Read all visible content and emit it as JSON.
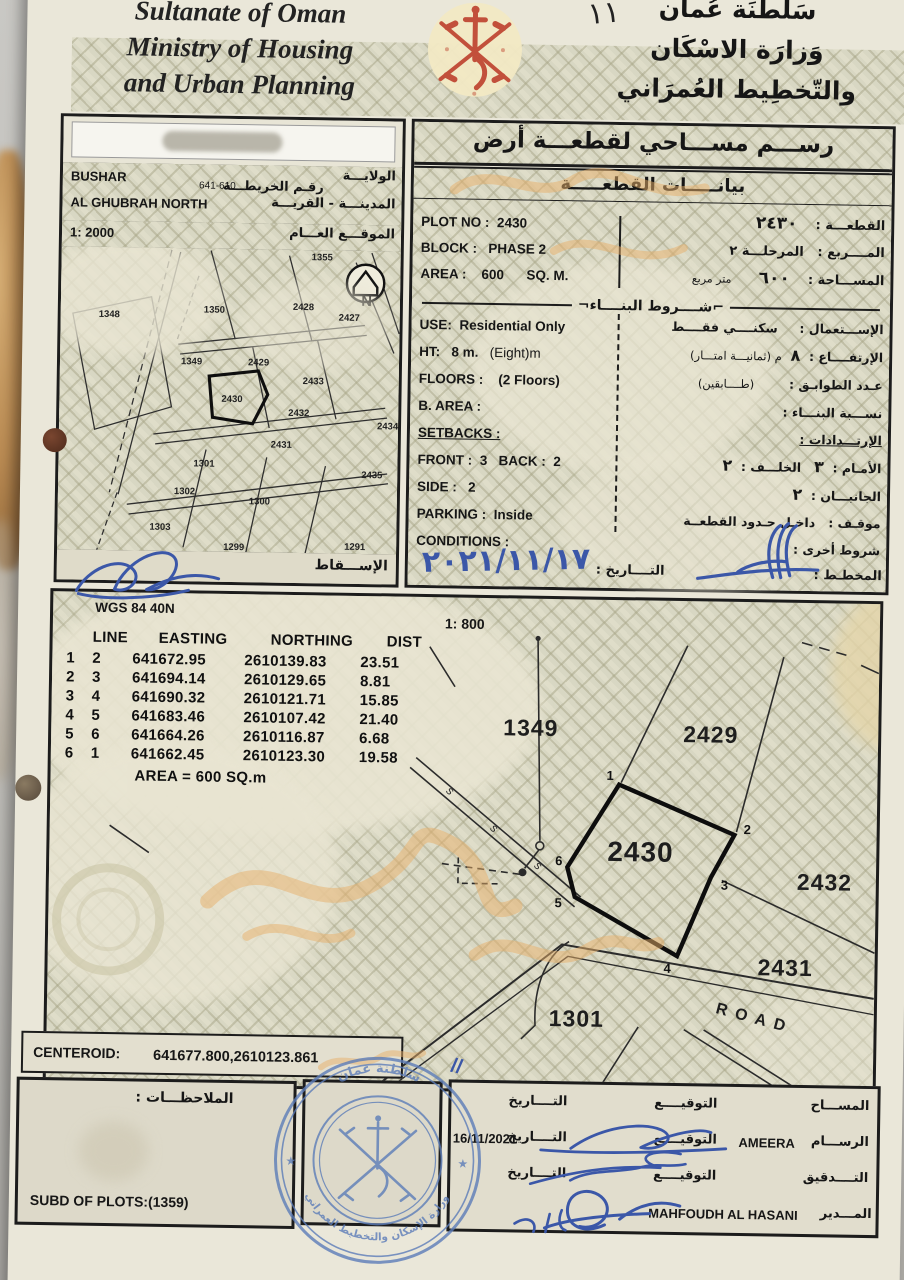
{
  "header": {
    "en_line1": "Sultanate of Oman",
    "en_line2": "Ministry of Housing",
    "en_line3": "and Urban Planning",
    "ar_line1": "سَلْطنَة عُمان",
    "ar_line2": "وَزارَة الاسْكَان",
    "ar_line3": "والتّخطِيط العُمرَاني",
    "page_mark": "١١"
  },
  "location": {
    "wilayat_label_ar": "الولايـــة",
    "wilayat_value": "BUSHAR",
    "map_no_label_ar": "رقـم الخريطـــة",
    "map_no": "641-610",
    "town_label_ar": "المدينـــة - القريـــة",
    "town_value": "AL GHUBRAH NORTH",
    "scale_label": "1: 2000",
    "site_label_ar": "الموقـــع العـــام",
    "projection_label_ar": "الإســـقاط"
  },
  "map_labels": [
    "1348",
    "1350",
    "1355",
    "2428",
    "2427",
    "1349",
    "2429",
    "2433",
    "2430",
    "2432",
    "2434",
    "2431",
    "1301",
    "1302",
    "1300",
    "2435",
    "1303",
    "1299",
    "1291"
  ],
  "title": {
    "main_ar": "رســـم مســـاحي لقطعـــة أرض",
    "sub_ar": "بيانـــــات القطعـــــة"
  },
  "plot": {
    "no_label": "PLOT NO :",
    "no": "2430",
    "block_label": "BLOCK :",
    "block": "PHASE 2",
    "area_label": "AREA :",
    "area": "600",
    "area_unit": "SQ. M.",
    "no_ar_label": "القطعـــة :",
    "no_ar_value": "٢٤٣٠",
    "block_ar_label": "المــــربع :",
    "block_ar_value": "المرحلـــة ٢",
    "area_ar_label": "المســـاحة :",
    "area_ar_value": "٦٠٠",
    "area_ar_unit": "متر مربع"
  },
  "building": {
    "header_ar": "شــــروط البنــــاء",
    "use_label": "USE:",
    "use_value": "Residential Only",
    "use_ar_label": "الإســـتعمال :",
    "use_ar_value": "سكنــــي فقــــط",
    "ht_label": "HT:",
    "ht_value": "8 m.",
    "ht_note": "(Eight)m",
    "ht_ar_label": "الإرتفــــاع :",
    "ht_ar_value": "٨",
    "ht_ar_note": "م  (ثمانيـــة امتـــار)",
    "floors_label": "FLOORS :",
    "floors_value": "(2 Floors)",
    "floors_ar_label": "عـدد الطوابـق :",
    "floors_ar_value": "(طــــابقين)",
    "barea_label": "B. AREA :",
    "barea_ar_label": "نســـبة البنـــاء :",
    "setbacks_label": "SETBACKS :",
    "setbacks_ar_label": "الإرتـــدادات :",
    "front_label": "FRONT :",
    "front_value": "3",
    "back_label": "BACK :",
    "back_value": "2",
    "front_ar_label": "الأمـام :",
    "front_ar_value": "٣",
    "back_ar_label": "الخلـــف :",
    "back_ar_value": "٢",
    "side_label": "SIDE :",
    "side_value": "2",
    "side_ar_label": "الجانبـــان :",
    "side_ar_value": "٢",
    "parking_label": "PARKING :",
    "parking_value": "Inside",
    "parking_ar_label": "موقـف :",
    "parking_ar_value": "داخـل حـدود القطعــة",
    "conditions_label": "CONDITIONS :",
    "conditions_ar_label": "شروط أخرى :"
  },
  "footer_date": {
    "date_label_ar": "التــــاريخ :",
    "date_value": "٢٠٢١/١١/١٧",
    "planner_label_ar": "المخطـط :"
  },
  "survey": {
    "datum": "WGS 84  40N",
    "scale": "1: 800",
    "table": {
      "headers": [
        "LINE",
        "EASTING",
        "NORTHING",
        "DIST"
      ],
      "rows": [
        [
          "1",
          "2",
          "641672.95",
          "2610139.83",
          "23.51"
        ],
        [
          "2",
          "3",
          "641694.14",
          "2610129.65",
          "8.81"
        ],
        [
          "3",
          "4",
          "641690.32",
          "2610121.71",
          "15.85"
        ],
        [
          "4",
          "5",
          "641683.46",
          "2610107.42",
          "21.40"
        ],
        [
          "5",
          "6",
          "641664.26",
          "2610116.87",
          "6.68"
        ],
        [
          "6",
          "1",
          "641662.45",
          "2610123.30",
          "19.58"
        ]
      ]
    },
    "area_note": "AREA = 600  SQ.m"
  },
  "drawing": {
    "plot_label": "2430",
    "vertices": [
      "1",
      "2",
      "3",
      "4",
      "5",
      "6"
    ],
    "neighbors": [
      "1349",
      "2429",
      "2432",
      "2431",
      "1301"
    ],
    "road": "ROAD"
  },
  "centeroid": {
    "label": "CENTEROID:",
    "value": "641677.800,2610123.861"
  },
  "notes": {
    "label_ar": "الملاحظـــات :",
    "subd": "SUBD OF PLOTS:(1359)"
  },
  "signatures": {
    "surveyor_ar": "المســـاح",
    "draftsman_ar": "الرســـام",
    "checking_ar": "التــــدقيق",
    "director_ar": "المـــدير",
    "signature_ar": "التوقيــــع",
    "date_ar": "التــــاريخ",
    "draftsman_name": "AMEERA",
    "draft_date": "16/11/2021",
    "director_name": "MAHFOUDH AL HASANI"
  },
  "stamp": {
    "top": "سلطنة عمان",
    "bottom": "وزارة الإسكان والتخطيط العمراني"
  },
  "colors": {
    "ink_blue": "#3b57a8",
    "stamp_blue": "#5c7cb8",
    "emblem_red": "#c2503b",
    "pattern_olive": "#d8d7c3",
    "paper": "#eae7d9",
    "accent_orange": "#e8b069"
  }
}
